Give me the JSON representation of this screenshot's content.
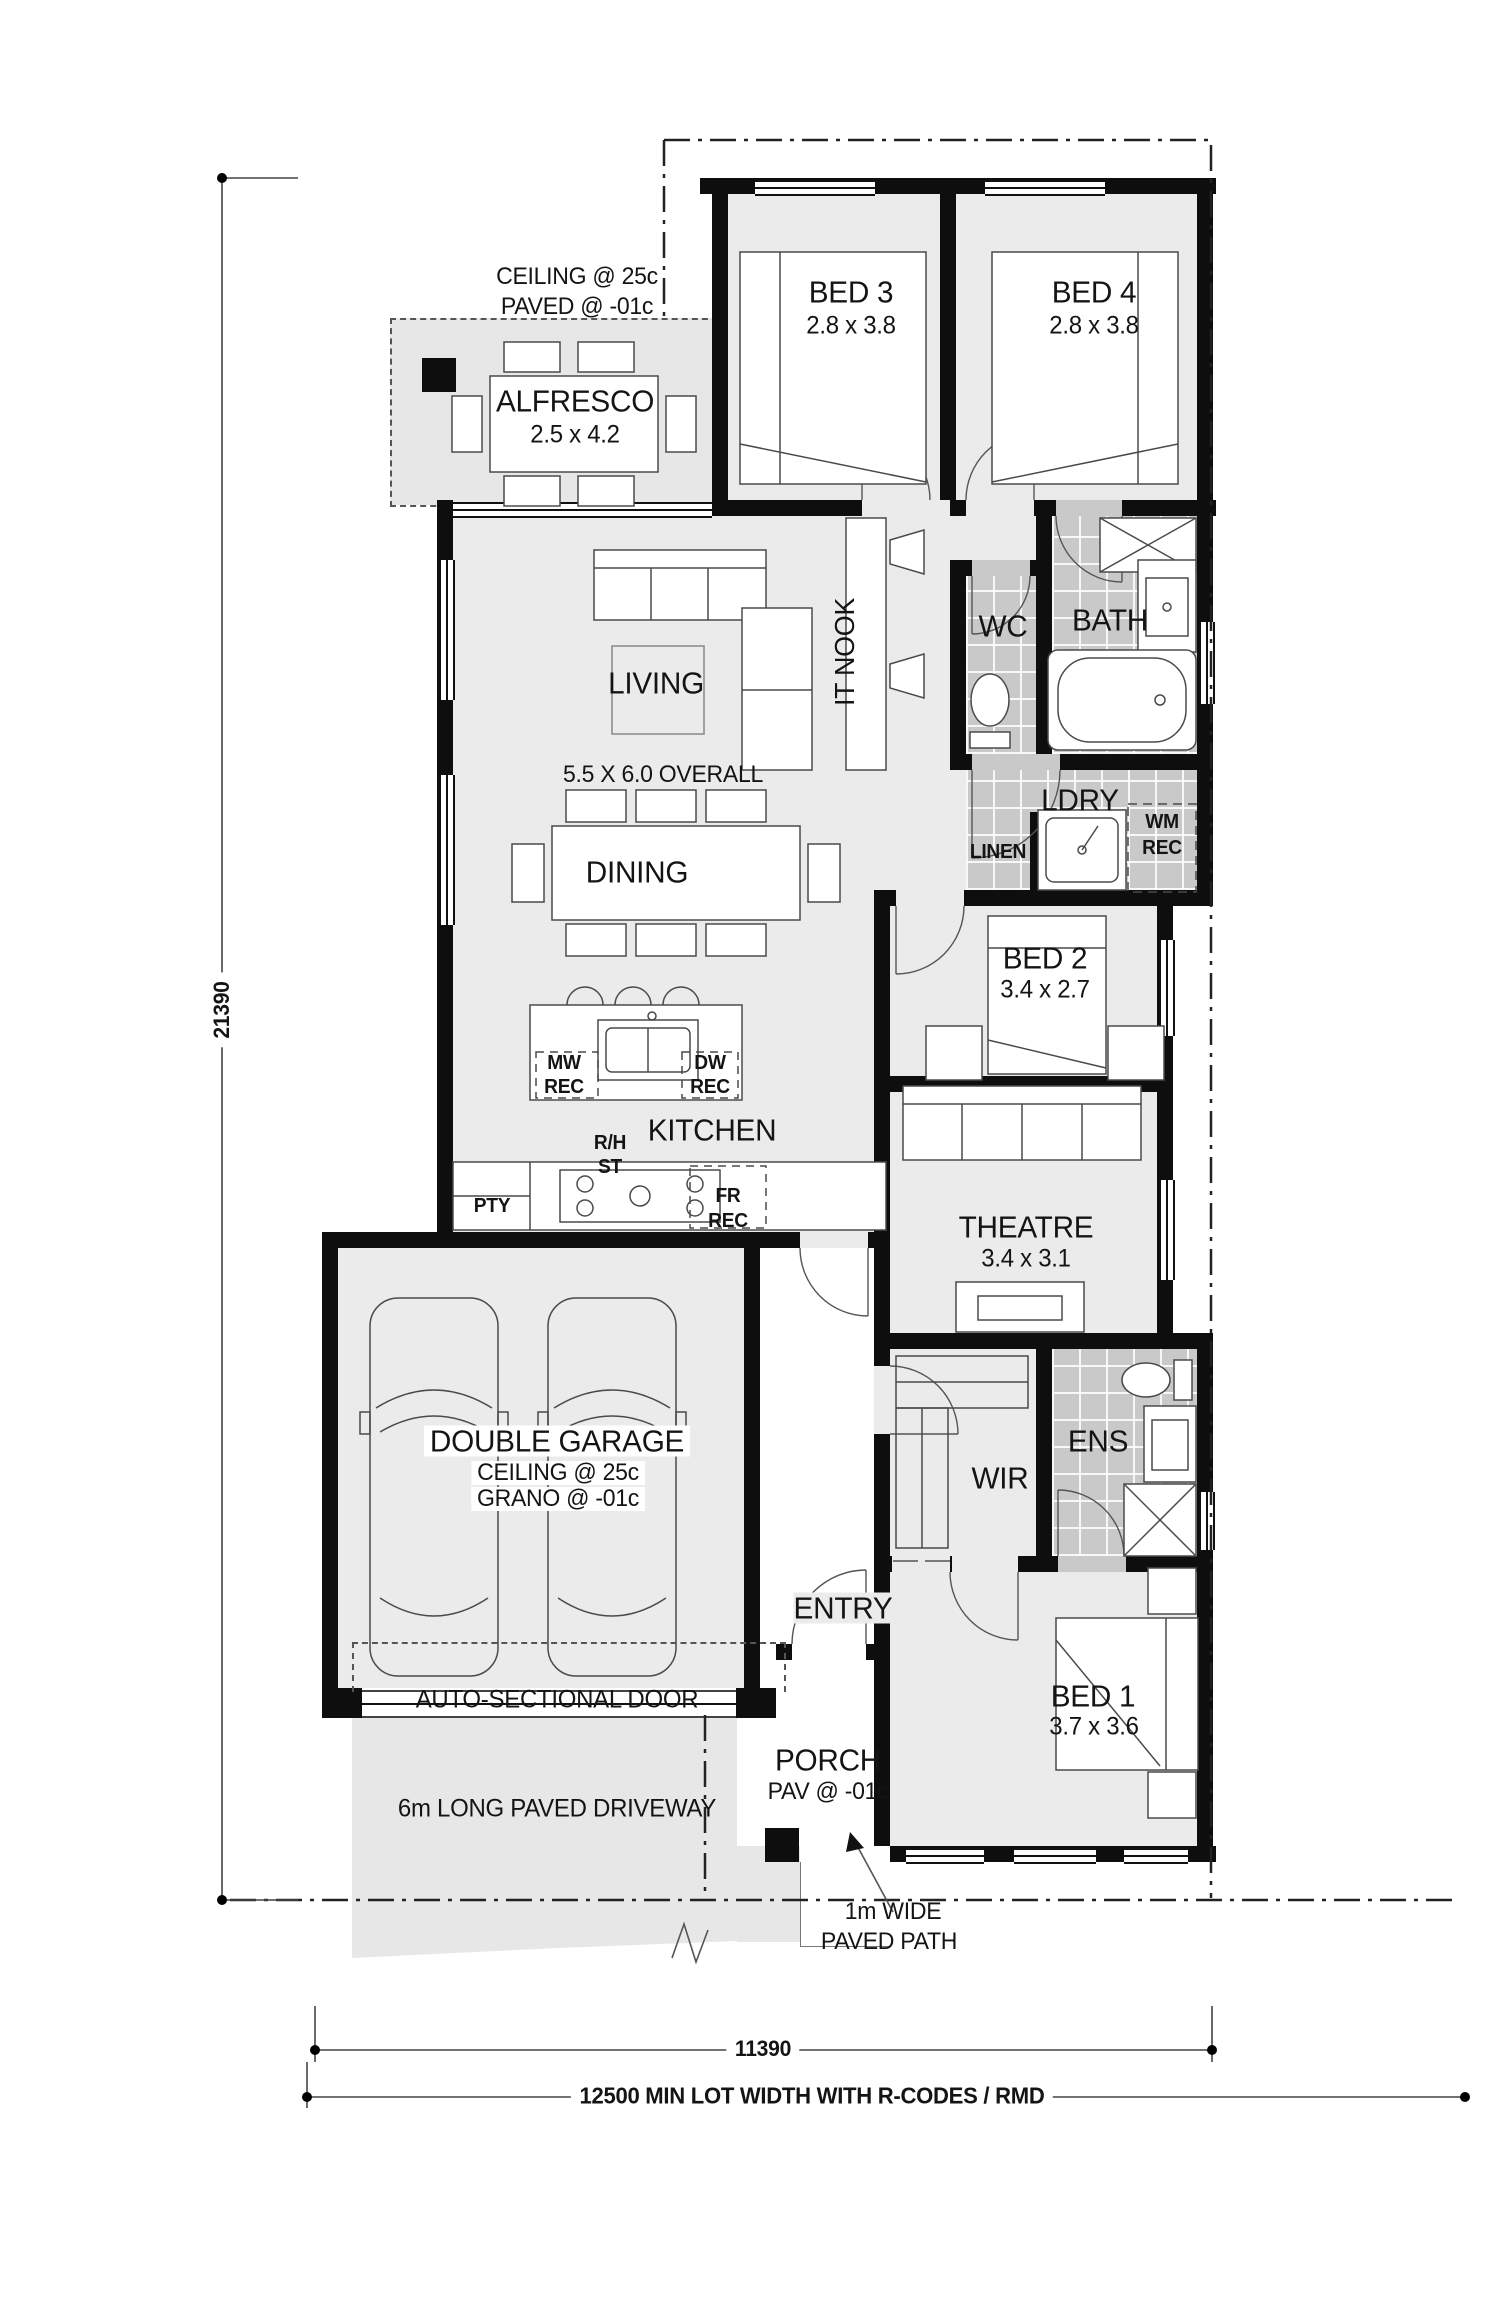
{
  "plan": {
    "alfresco_notes": {
      "line1": "CEILING @ 25c",
      "line2": "PAVED @ -01c"
    },
    "rooms": {
      "bed3": {
        "name": "BED 3",
        "dims": "2.8 x 3.8"
      },
      "bed4": {
        "name": "BED 4",
        "dims": "2.8 x 3.8"
      },
      "alfresco": {
        "name": "ALFRESCO",
        "dims": "2.5 x 4.2"
      },
      "living": {
        "name": "LIVING",
        "overall": "5.5 X 6.0 OVERALL"
      },
      "it_nook": {
        "name": "IT NOOK"
      },
      "dining": {
        "name": "DINING"
      },
      "kitchen": {
        "name": "KITCHEN"
      },
      "wc": {
        "name": "WC"
      },
      "bath": {
        "name": "BATH"
      },
      "ldry": {
        "name": "LDRY"
      },
      "linen": {
        "name": "LINEN"
      },
      "bed2": {
        "name": "BED 2",
        "dims": "3.4 x 2.7"
      },
      "theatre": {
        "name": "THEATRE",
        "dims": "3.4 x 3.1"
      },
      "garage": {
        "name": "DOUBLE GARAGE",
        "note1": "CEILING @ 25c",
        "note2": "GRANO @ -01c"
      },
      "wir": {
        "name": "WIR"
      },
      "ens": {
        "name": "ENS"
      },
      "entry": {
        "name": "ENTRY"
      },
      "bed1": {
        "name": "BED 1",
        "dims": "3.7 x 3.6"
      },
      "porch": {
        "name": "PORCH",
        "note": "PAV @ -01c"
      }
    },
    "recesses": {
      "wm": {
        "line1": "WM",
        "line2": "REC"
      },
      "mw": {
        "line1": "MW",
        "line2": "REC"
      },
      "dw": {
        "line1": "DW",
        "line2": "REC"
      },
      "fr": {
        "line1": "FR",
        "line2": "REC"
      },
      "rh": {
        "line1": "R/H",
        "line2": "ST"
      },
      "pty": "PTY"
    },
    "site": {
      "auto_door": "AUTO-SECTIONAL DOOR",
      "driveway": "6m LONG PAVED DRIVEWAY",
      "path": {
        "line1": "1m WIDE",
        "line2": "PAVED PATH"
      }
    },
    "dimensions": {
      "depth": "21390",
      "width": "11390",
      "lot_width": "12500 MIN LOT WIDTH WITH R-CODES / RMD"
    }
  }
}
